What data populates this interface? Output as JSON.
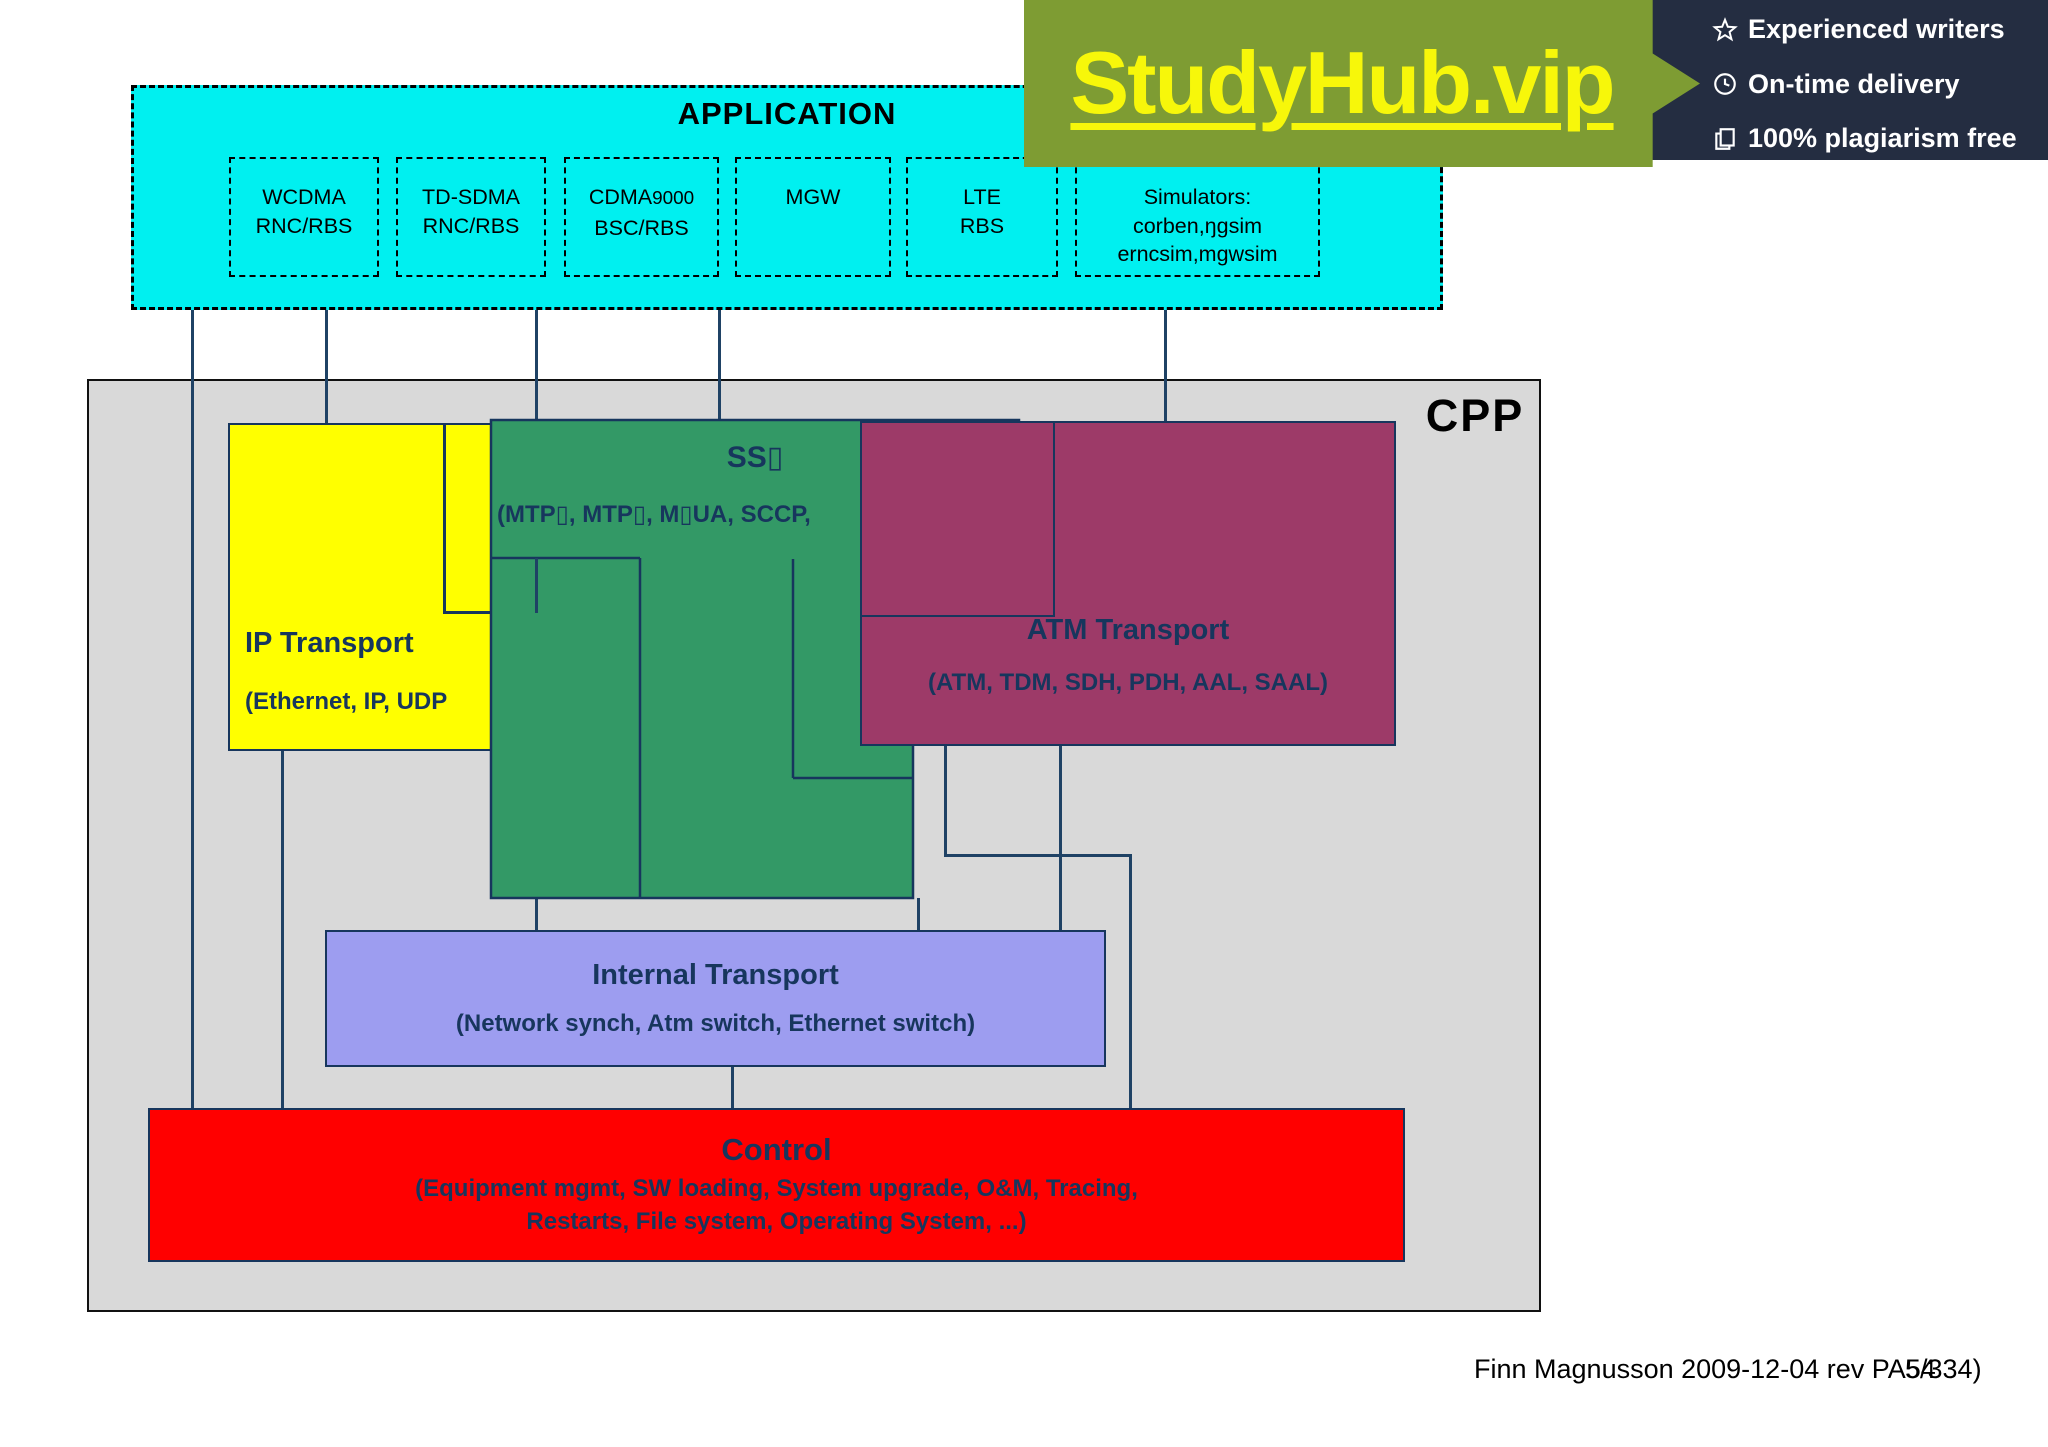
{
  "banner": {
    "site": "StudyHub.vip",
    "features": [
      {
        "icon": "star-icon",
        "label": "Experienced writers"
      },
      {
        "icon": "clock-icon",
        "label": "On-time delivery"
      },
      {
        "icon": "copy-icon",
        "label": "100% plagiarism free"
      }
    ]
  },
  "application": {
    "title": "APPLICATION",
    "boxes": [
      {
        "line1": "WCDMA",
        "line2": "RNC/RBS"
      },
      {
        "line1": "TD-SDMA",
        "line2": "RNC/RBS"
      },
      {
        "line1": "CDMA",
        "line1_suffix": "9000",
        "line2": "BSC/RBS"
      },
      {
        "line1": "MGW"
      },
      {
        "line1": "LTE",
        "line2": "RBS"
      },
      {
        "line1": "Simulators:",
        "line2": "corben,ŋgsim",
        "line3": "erncsim,mgwsim"
      }
    ]
  },
  "cpp": {
    "label": "CPP",
    "ip": {
      "title": "IP Transport",
      "subtitle": "(Ethernet, IP, UDP"
    },
    "ss7": {
      "title": "SS▯",
      "subtitle": "(MTP▯, MTP▯, M▯UA, SCCP,"
    },
    "atm": {
      "title": "ATM Transport",
      "subtitle": "(ATM, TDM, SDH, PDH, AAL, SAAL)"
    },
    "internal": {
      "title": "Internal Transport",
      "subtitle": "(Network synch, Atm switch, Ethernet switch)"
    },
    "control": {
      "title": "Control",
      "line1": "(Equipment mgmt, SW loading, System upgrade, O&M, Tracing,",
      "line2": "Restarts, File system, Operating System, ...)"
    }
  },
  "footer": {
    "author": "Finn Magnusson 2009-12-04 rev PA54",
    "page": "5/334)"
  },
  "colors": {
    "application_cyan": "#00f0f0",
    "cpp_gray": "#d9d9d9",
    "ip_yellow": "#ffff00",
    "ss7_green": "#339966",
    "atm_maroon": "#9d3a68",
    "internal_lavender": "#9d9df0",
    "control_red": "#ff0000",
    "box_text_navy": "#17365d",
    "connector_navy": "#1f4265",
    "banner_olive": "#7e9c33",
    "banner_navy": "#242d41",
    "banner_yellow": "#f7f70a"
  }
}
